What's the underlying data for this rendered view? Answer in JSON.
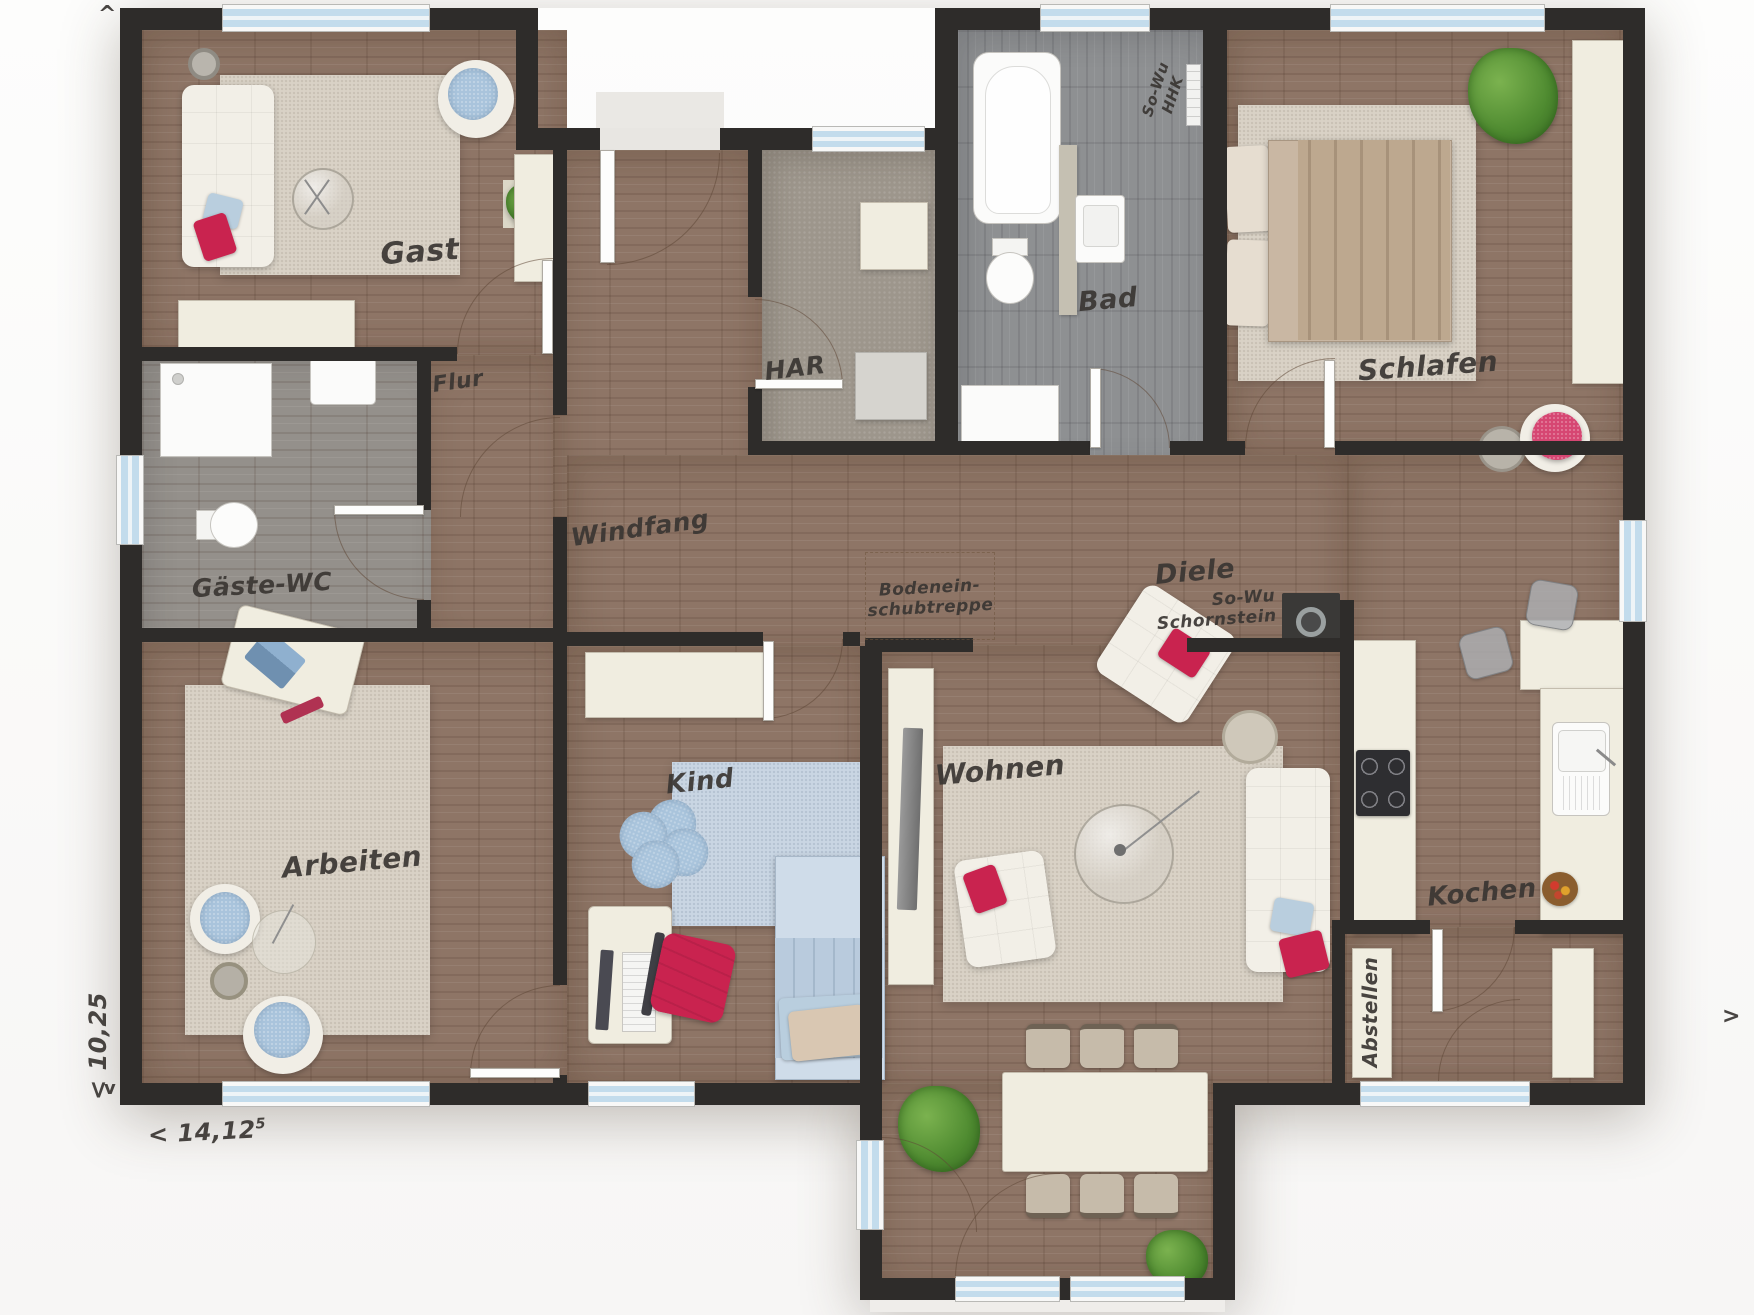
{
  "rooms": {
    "gast": {
      "label": "Gast"
    },
    "flur": {
      "label": "Flur"
    },
    "gaeste_wc": {
      "label": "Gäste-WC"
    },
    "arbeiten": {
      "label": "Arbeiten"
    },
    "windfang": {
      "label": "Windfang"
    },
    "har": {
      "label": "HAR"
    },
    "bad": {
      "label": "Bad"
    },
    "schlafen": {
      "label": "Schlafen"
    },
    "diele": {
      "label": "Diele"
    },
    "kind": {
      "label": "Kind"
    },
    "wohnen": {
      "label": "Wohnen"
    },
    "kochen": {
      "label": "Kochen"
    },
    "abstellen": {
      "label": "Abstellen"
    }
  },
  "annotations": {
    "loft_ladder": {
      "line1": "Bodenein-",
      "line2": "schubtreppe"
    },
    "chimney": {
      "line1": "So-Wu",
      "line2": "Schornstein"
    },
    "hhk": {
      "line1": "So-Wu",
      "line2": "HHK"
    }
  },
  "dimensions": {
    "width_value": "< 14,12",
    "width_sup": "5",
    "height_value": "< 10,25",
    "arrow_up": "^",
    "arrow_down": "v",
    "arrow_right": ">"
  },
  "colors": {
    "wall": "#2e2c2a",
    "wood_floor": "#8e7566",
    "grey_wood_floor": "#94908b",
    "bad_floor": "#8e9092",
    "har_carpet": "#9d968c",
    "rug_beige": "#d9d2c6",
    "rug_blue": "#c9d6e3",
    "furniture_cream": "#f0ede0",
    "accent_red": "#c9234f",
    "accent_blue": "#a9c4dc",
    "plant_green": "#5f9c3c",
    "window_glass": "#c3dcec"
  }
}
